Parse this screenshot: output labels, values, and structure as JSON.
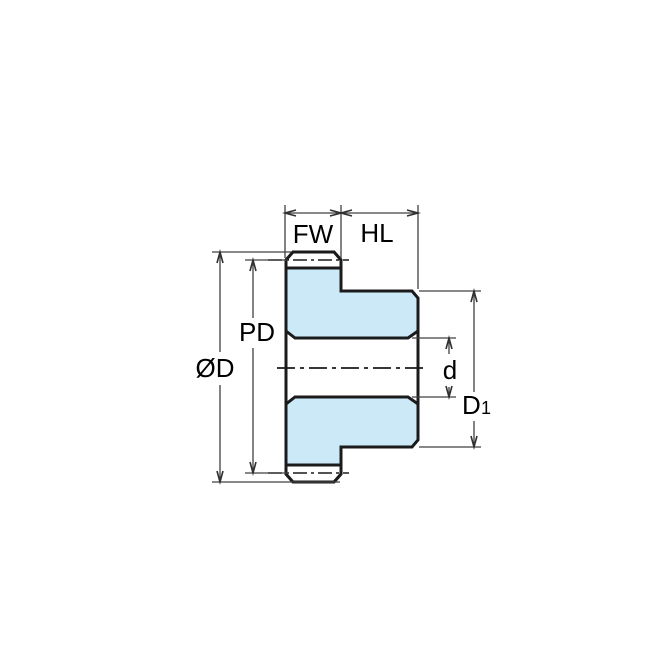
{
  "diagram": {
    "labels": {
      "face_width": "FW",
      "hub_length": "HL",
      "pitch_diameter": "PD",
      "outside_diameter": "ØD",
      "bore_diameter": "d",
      "hub_diameter_main": "D",
      "hub_diameter_sub": "1"
    },
    "colors": {
      "part_fill": "#cce9f8",
      "outline": "#1b1b1d",
      "dimension_line": "#404040",
      "background": "#ffffff"
    }
  }
}
